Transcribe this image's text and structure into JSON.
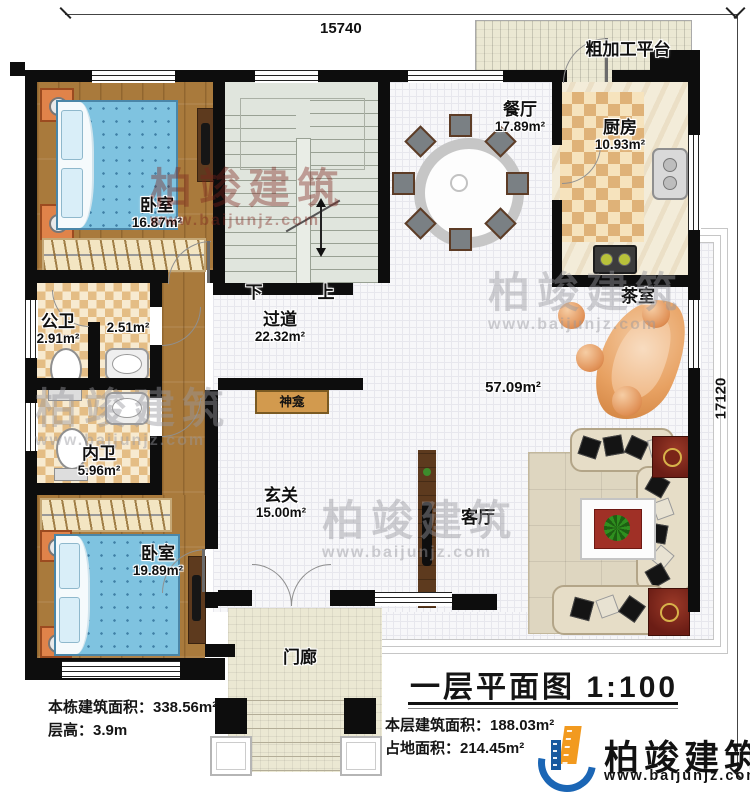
{
  "plan": {
    "title": "一层平面图 1:100",
    "dim_top": "15740",
    "dim_right": "17120",
    "stairs": {
      "down_label": "下",
      "up_label": "上"
    },
    "rooms": {
      "bedroom1": {
        "name": "卧室",
        "area": "16.87m²"
      },
      "dining": {
        "name": "餐厅",
        "area": "17.89m²"
      },
      "kitchen": {
        "name": "厨房",
        "area": "10.93m²"
      },
      "platform": {
        "name": "粗加工平台"
      },
      "tearoom": {
        "name": "茶室"
      },
      "corridor": {
        "name": "过道",
        "area": "22.32m²"
      },
      "public_bath": {
        "name": "公卫",
        "area": "2.91m²"
      },
      "washroom": {
        "area": "2.51m²"
      },
      "private_bath": {
        "name": "内卫",
        "area": "5.96m²"
      },
      "bedroom2": {
        "name": "卧室",
        "area": "19.89m²"
      },
      "entry": {
        "name": "玄关",
        "area": "15.00m²"
      },
      "living": {
        "name": "客厅"
      },
      "porch": {
        "name": "门廊"
      },
      "shrine": {
        "name": "神龛"
      },
      "open_area": {
        "area": "57.09m²"
      }
    },
    "notes": {
      "building_area": "本栋建筑面积：338.56m²",
      "floor_height": "层高：3.9m",
      "floor_area": "本层建筑面积：188.03m²",
      "footprint": "占地面积：214.45m²"
    }
  },
  "brand": {
    "name": "柏竣建筑",
    "url": "www.baijunjz.com"
  },
  "watermark": {
    "name": "柏竣建筑",
    "url": "www.baijunjz.com"
  },
  "colors": {
    "wall": "#0d0d0d",
    "brand_blue": "#1b66b5",
    "brand_orange": "#f29a1f",
    "wood": "#a97a3c"
  }
}
